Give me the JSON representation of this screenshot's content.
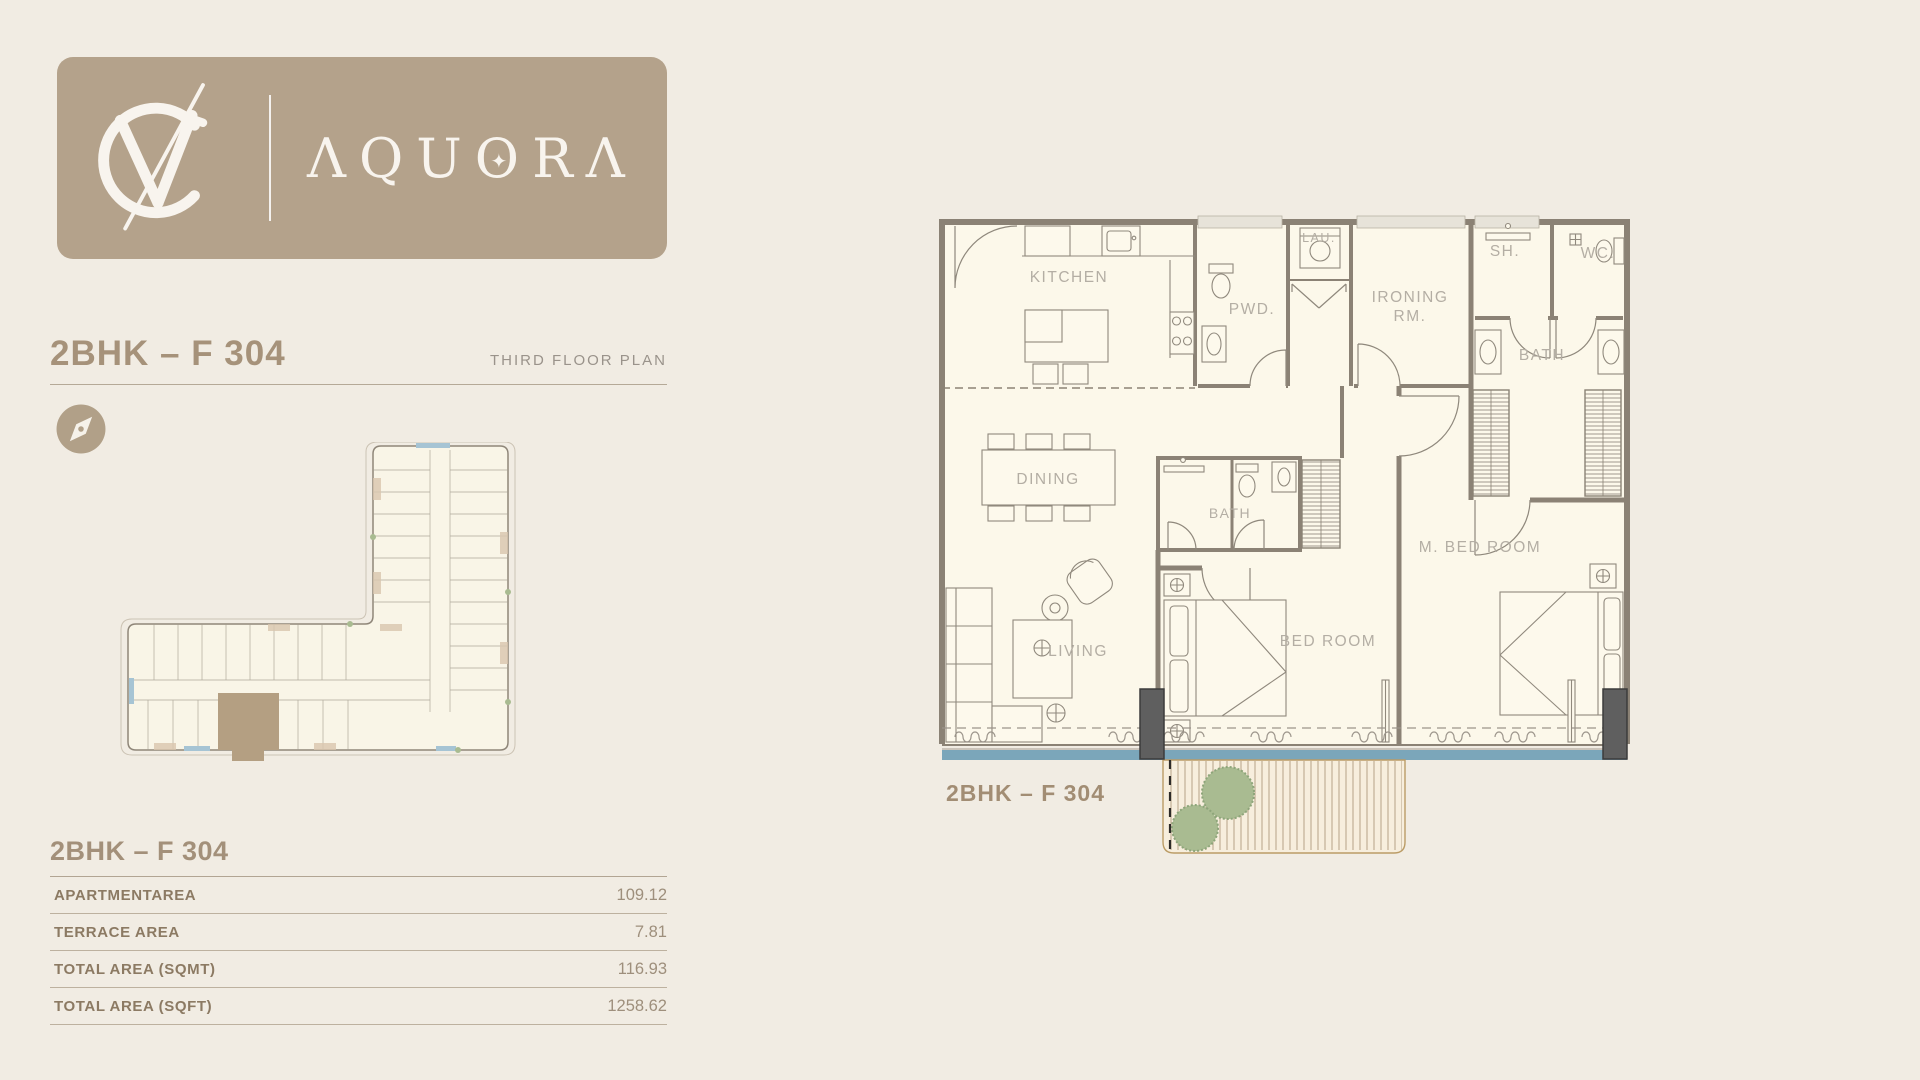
{
  "brand": {
    "monogram": "VC",
    "name": "AQUORA",
    "display": {
      "pre": "ΛQU",
      "o": "O",
      "star": "✦",
      "post": "RΛ"
    }
  },
  "header": {
    "title": "2BHK – F 304",
    "subtitle": "THIRD FLOOR PLAN"
  },
  "areas": {
    "title": "2BHK – F 304",
    "rows": [
      {
        "label": "APARTMENTAREA",
        "value": "109.12"
      },
      {
        "label": "TERRACE AREA",
        "value": "7.81"
      },
      {
        "label": "TOTAL AREA (SQMT)",
        "value": "116.93"
      },
      {
        "label": "TOTAL AREA (SQFT)",
        "value": "1258.62"
      }
    ]
  },
  "floorplan": {
    "unit_label": "2BHK – F 304",
    "rooms": {
      "kitchen": "KITCHEN",
      "pwd": "PWD.",
      "laundry": "LAU.",
      "ironing_line1": "IRONING",
      "ironing_line2": "RM.",
      "shower": "SH.",
      "wc": "WC.",
      "master_bath": "BATH",
      "dining": "DINING",
      "bath2": "BATH",
      "master_bedroom": "M. BED ROOM",
      "bedroom": "BED ROOM",
      "living": "LIVING"
    }
  },
  "icons": {
    "compass": "compass-needle-icon"
  },
  "colors": {
    "background": "#f1ece3",
    "card": "#b4a28b",
    "heading": "#a6927a",
    "subtitle": "#9a938b",
    "table_label": "#8c7a63",
    "table_value": "#9e8f7c",
    "plan_bg": "#fcf8ea",
    "wall": "#8b8275",
    "water": "#7ba6ba",
    "deck": "#f7eedd",
    "deck_edge": "#bb9c66",
    "tree": "#a9bb91",
    "room_label": "#b4aea4",
    "highlight_unit": "#b49f82"
  }
}
